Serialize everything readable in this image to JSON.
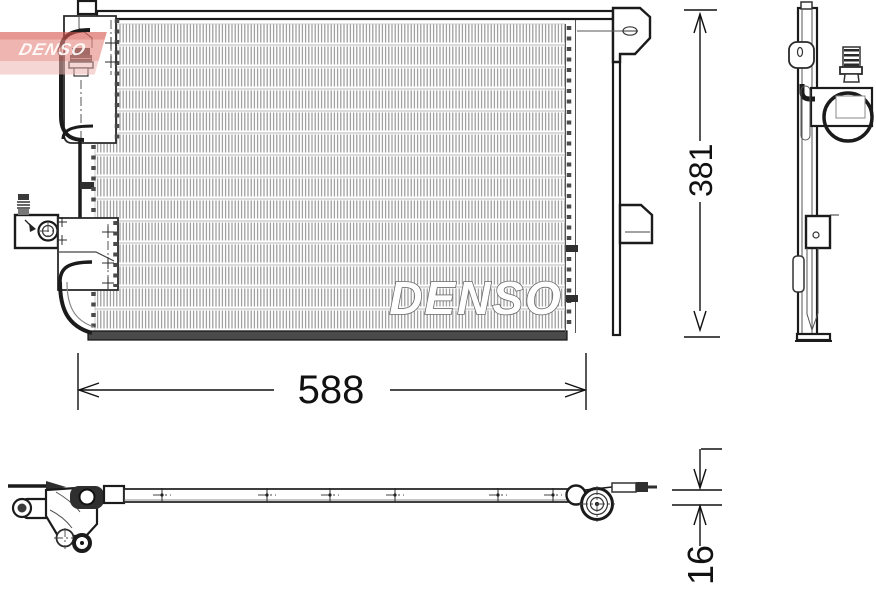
{
  "drawing": {
    "logo_text": "DENSO",
    "watermark_text": "DENSO",
    "dim_width": "588",
    "dim_height": "381",
    "dim_depth": "16",
    "colors": {
      "line": "#1b1b1b",
      "fin_line": "#8f8f8f",
      "dim_text": "#111111",
      "logo_band_top": "#d9574e",
      "logo_band_main": "#e58880",
      "logo_band_bottom": "#efb5b0",
      "logo_text_color": "#ffffff",
      "watermark_fill": "#ffffff",
      "watermark_outline": "#6a6a6a"
    }
  }
}
